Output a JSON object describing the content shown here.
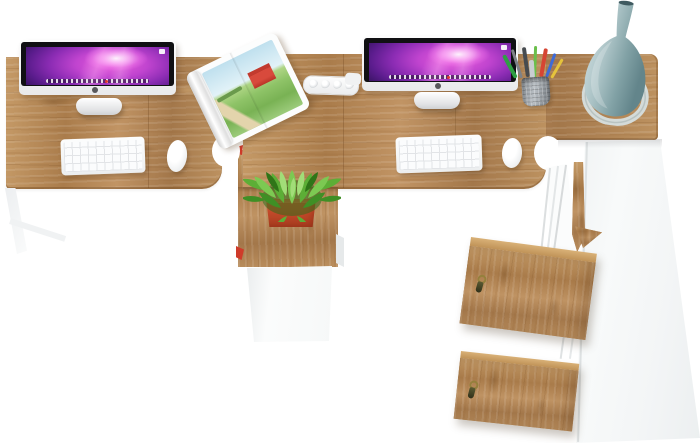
{
  "image": {
    "width": 700,
    "height": 443,
    "background": "#ffffff",
    "description": "Top-down product photo of a two-person office desk set: oak desktops with white legs, two iMac computers with white keyboards and mice, an open magazine with a farm photo, a white cable hub, a mesh pencil cup, a green potted plant on a low oak pedestal, a teal bottle-shaped vase on a ring stand, and a tall white cabinet with two locked oak doors."
  },
  "palette": {
    "wood": "#b5854f",
    "wood_dark": "#8a6234",
    "wood_light": "#c9a06b",
    "furniture_white": "#f6f7f8",
    "screen_magenta": "#ea5ddd",
    "screen_deep_purple": "#2e1156",
    "plant_green": "#5cae36",
    "pot_red": "#d2512f",
    "vase_teal": "#82a2a6",
    "ring_grey": "#d4dbd9",
    "key_olive": "#55522e",
    "accent_red": "#cf3b2a"
  },
  "counts": {
    "workstations": 2,
    "imacs": 2,
    "keyboards": 2,
    "mice": 2,
    "oak_doors": 2,
    "keys": 2,
    "pens": 8
  },
  "scene": {
    "desk_left": {
      "label": "Left oak desk top"
    },
    "desk_right": {
      "label": "Right oak desk top"
    },
    "leg": {
      "label": "White tapered desk leg"
    },
    "imac_left": {
      "label": "iMac display (left workstation)"
    },
    "imac_right": {
      "label": "iMac display (right workstation)"
    },
    "keyboard_left": {
      "label": "White keyboard (left)"
    },
    "keyboard_right": {
      "label": "White keyboard (right)"
    },
    "mouse_left": {
      "label": "White mouse (left)"
    },
    "mouse_right": {
      "label": "White mouse (right)"
    },
    "magazine": {
      "label": "Open magazine with red barn photo"
    },
    "cable_hub": {
      "label": "White cable hub"
    },
    "pencil_cup": {
      "label": "Mesh pencil cup with colored pens"
    },
    "vase": {
      "label": "Teal bottle vase on ring stand"
    },
    "plant": {
      "label": "Green spiky plant in red pot"
    },
    "pedestal": {
      "label": "Oak pedestal cabinet with white front"
    },
    "cabinet": {
      "label": "Tall white side cabinet"
    },
    "door_upper": {
      "label": "Oak cabinet door with key (upper)"
    },
    "door_lower": {
      "label": "Oak cabinet door with key (lower)"
    }
  }
}
